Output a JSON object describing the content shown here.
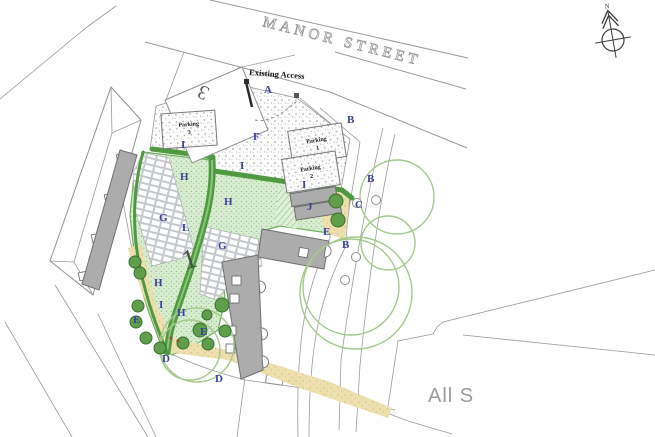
{
  "plan": {
    "street_label": "MANOR STREET",
    "access_label": "Existing Access",
    "adjacent_site_label": "All S",
    "north_label": "N",
    "plot_number_main": "1",
    "plot_number_neighbor": "3",
    "parking_bays": [
      {
        "line1": "Parking",
        "line2": "3"
      },
      {
        "line1": "Parking",
        "line2": "1"
      },
      {
        "line1": "Parking",
        "line2": "2"
      }
    ],
    "zone_labels": {
      "A": "A",
      "B": "B",
      "C": "C",
      "D": "D",
      "E": "E",
      "F": "F",
      "G": "G",
      "H": "H",
      "I": "I",
      "J": "J",
      "L": "L"
    },
    "colors": {
      "label": "#39419e",
      "hedge": "#4f9a41",
      "lawn": "#d9ecd2",
      "canopy": "#a3c98b",
      "bush": "#5f9e4a",
      "building": "#acacac",
      "path_tan": "#eedfae",
      "line": "#9a9a9a"
    }
  }
}
